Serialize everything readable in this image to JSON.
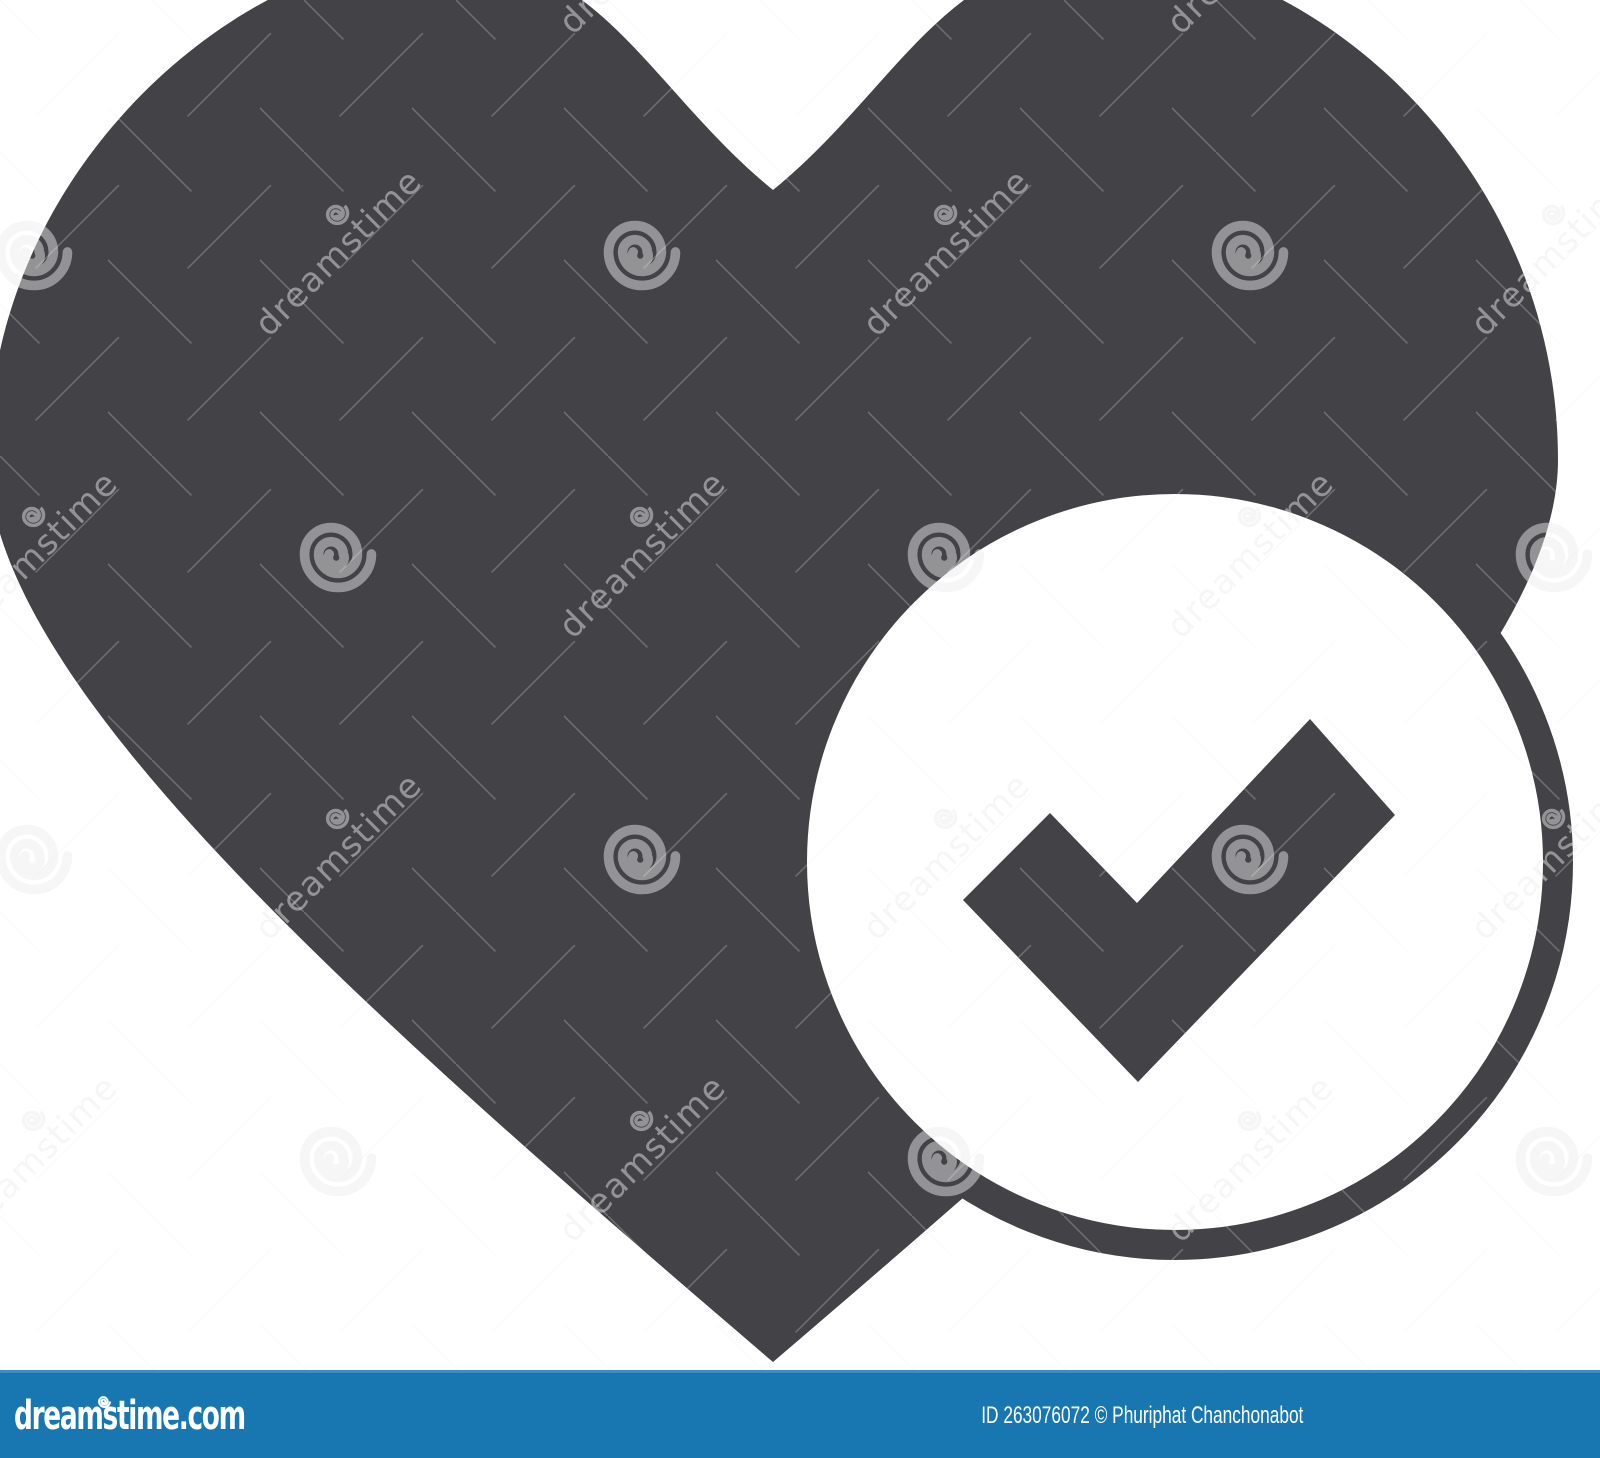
{
  "image": {
    "description": "Heart with check mark glyph icon, dark gray on white background, watermarked stock preview",
    "width_px": 1600,
    "height_px": 1458
  },
  "colors": {
    "icon_dark": "#424247",
    "background": "#ffffff",
    "footer_bar_blue": "#1877b0",
    "footer_bar_top_edge": "#3a8ec2",
    "watermark_light": "rgba(236,236,236,0.48)"
  },
  "watermark": {
    "brand_text": "dreamstime"
  },
  "footer": {
    "logo_text": "dreamstime.com",
    "credit_text": "ID 263076072 © Phuriphat Chanchonabot"
  }
}
